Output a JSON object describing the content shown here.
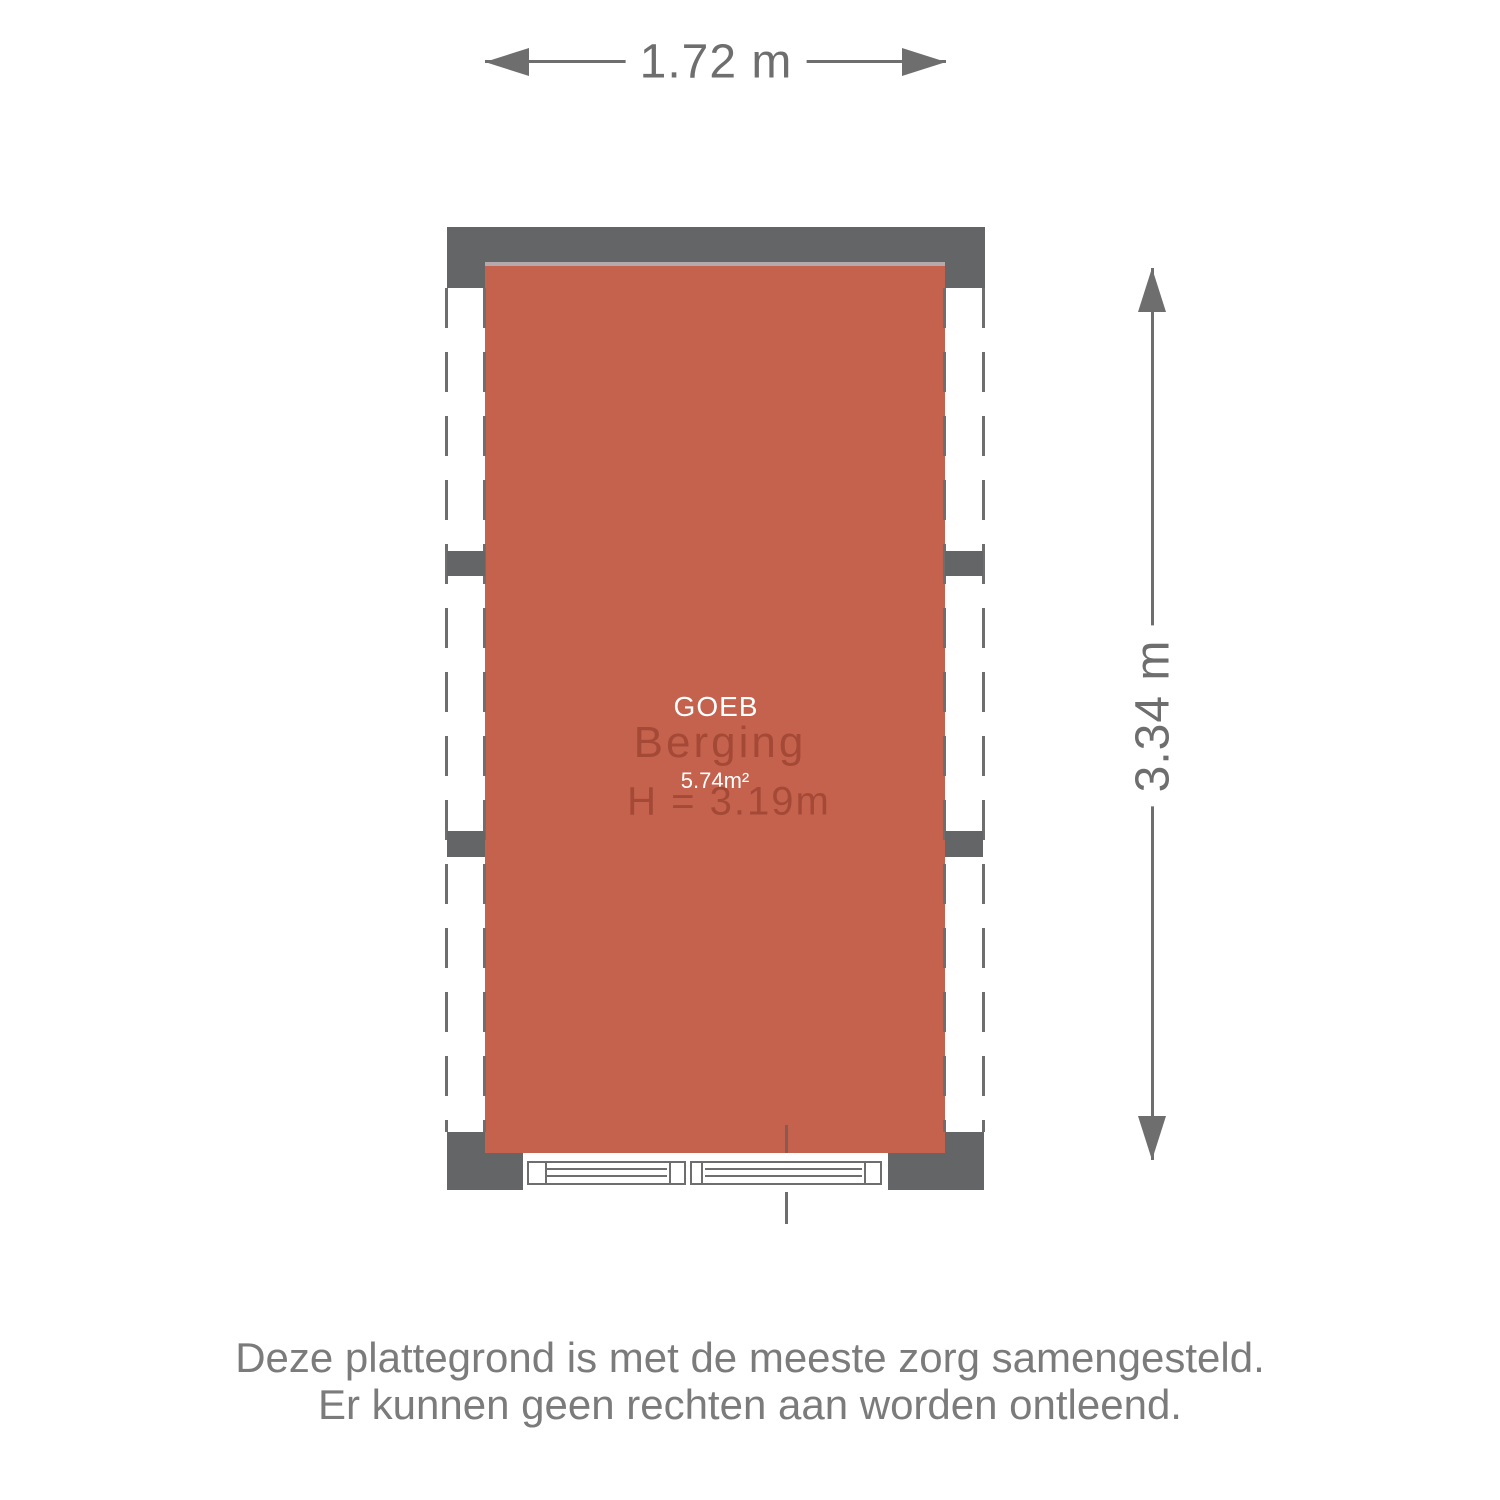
{
  "floorplan": {
    "room": {
      "overlay_label": "GOEB",
      "name": "Berging",
      "area_label": "5.74m²",
      "ceiling_height_label": "H = 3.19m"
    },
    "dimensions": {
      "width_label": "1.72 m",
      "height_label": "3.34 m"
    }
  },
  "disclaimer": {
    "line1": "Deze plattegrond is met de meeste zorg samengesteld.",
    "line2": "Er kunnen geen rechten aan worden ontleend."
  },
  "colors": {
    "room_fill": "#c4624d",
    "room_text": "#a54937",
    "room_top_edge": "#b4aaae",
    "wall": "#646567",
    "line": "#6e6e6e",
    "dim_text": "#6e6e6e",
    "disclaimer_text": "#7b7b7b"
  }
}
